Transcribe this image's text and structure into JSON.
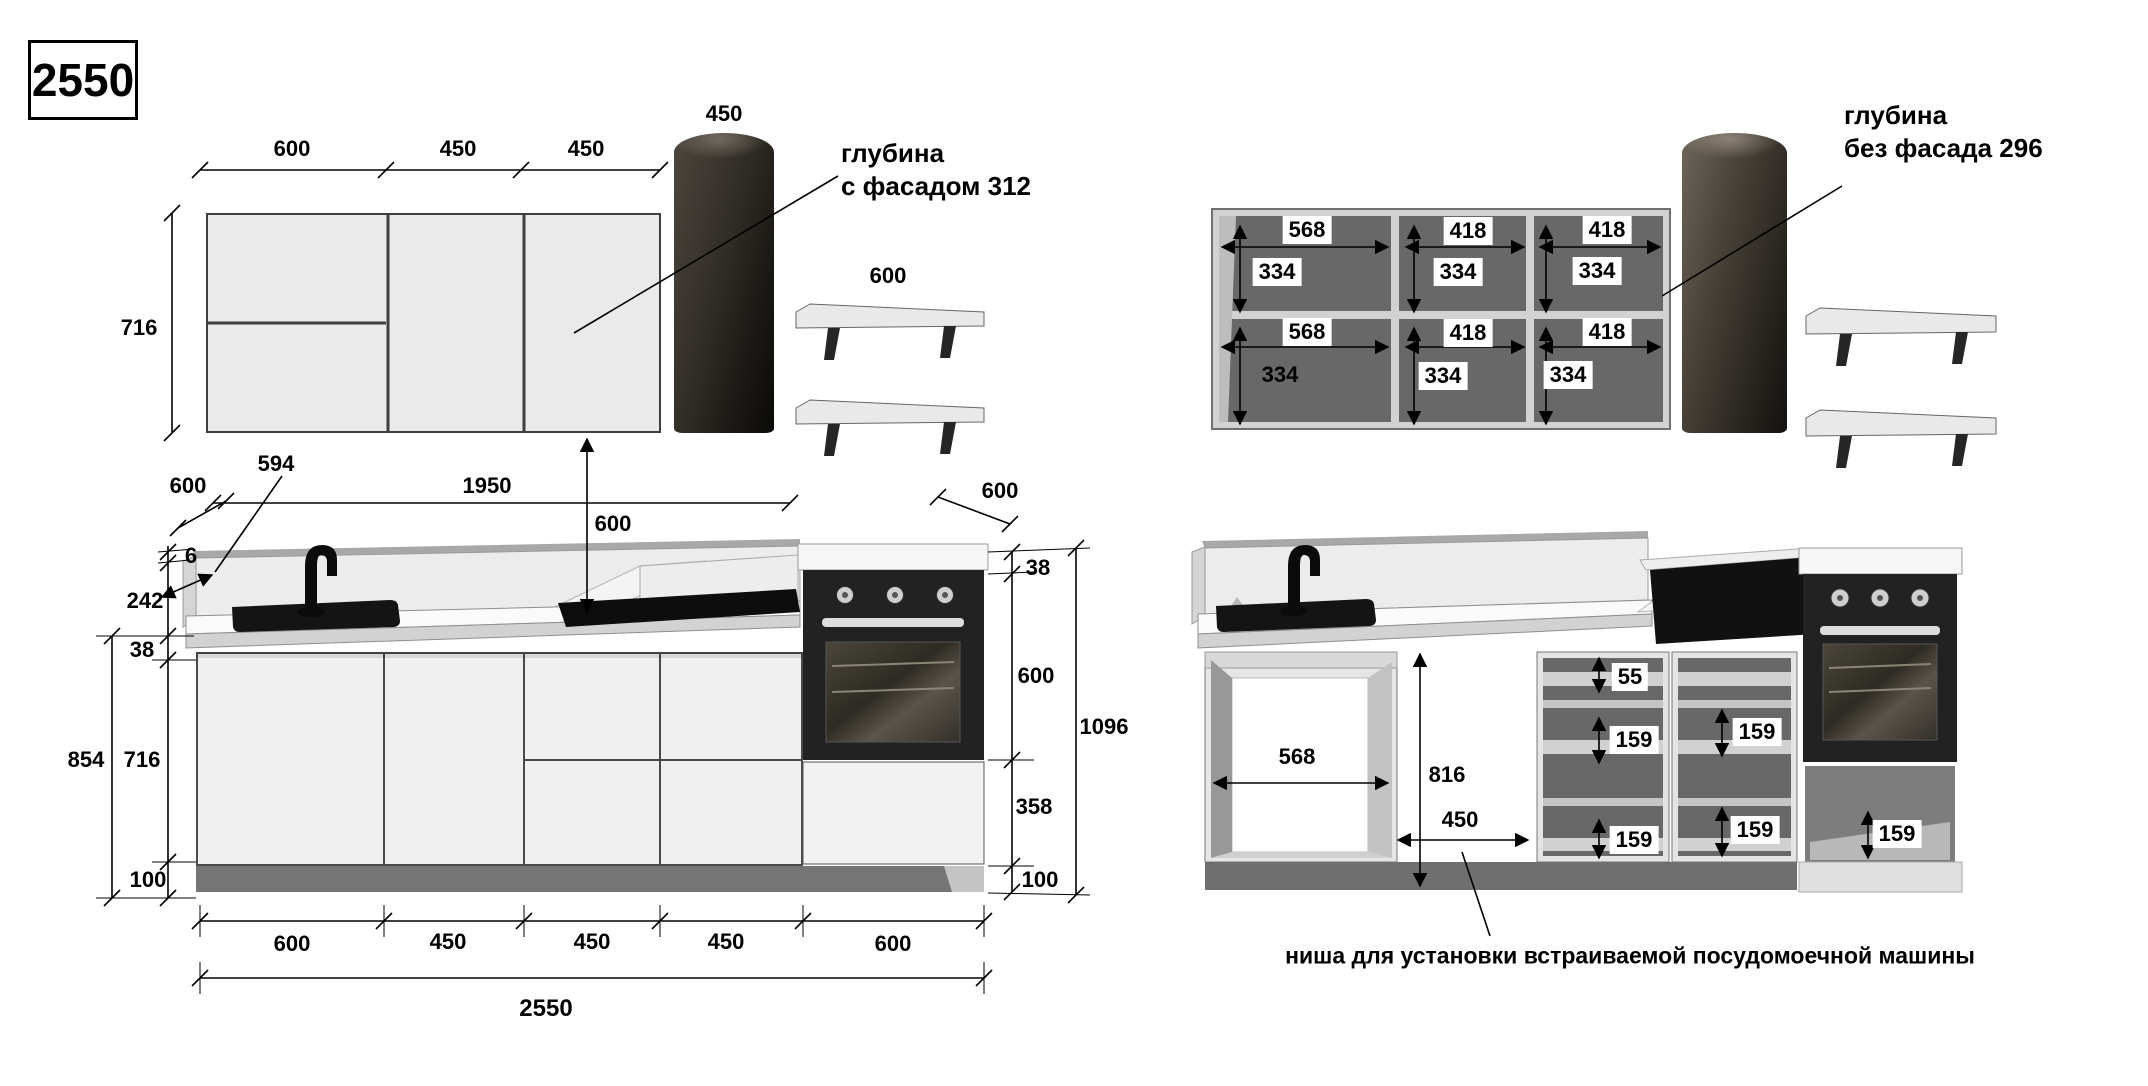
{
  "title_box": {
    "value": "2550"
  },
  "left_view": {
    "top_dims": [
      "600",
      "450",
      "450"
    ],
    "column_width_label": "450",
    "height_label": "716",
    "depth_note": {
      "line1": "глубина",
      "line2": "с фасадом 312"
    },
    "shelf_width_label": "600",
    "mid_dims": {
      "backsplash_594": "594",
      "depth_600": "600",
      "span_1950": "1950",
      "gap_600": "600",
      "shelf_depth_600": "600"
    },
    "left_dims": {
      "top_6": "6",
      "backsplash_242": "242",
      "counter_38": "38",
      "total_854": "854",
      "cabinet_716": "716",
      "plinth_100": "100"
    },
    "right_dims": {
      "counter_38": "38",
      "oven_600": "600",
      "total_1096": "1096",
      "drawer_358": "358",
      "plinth_100": "100"
    },
    "bottom_dims": [
      "600",
      "450",
      "450",
      "450",
      "600"
    ],
    "total_width": "2550"
  },
  "right_view": {
    "upper_compartments": [
      {
        "width": "568",
        "height": "334"
      },
      {
        "width": "418",
        "height": "334"
      },
      {
        "width": "418",
        "height": "334"
      },
      {
        "width": "568",
        "height": "334"
      },
      {
        "width": "418",
        "height": "334"
      },
      {
        "width": "418",
        "height": "334"
      }
    ],
    "depth_note": {
      "line1": "глубина",
      "line2": "без фасада 296"
    },
    "sink_opening_width": "568",
    "niche": {
      "height": "816",
      "width": "450"
    },
    "drawer_unit_a": {
      "top": "55",
      "mid": "159",
      "bottom": "159"
    },
    "drawer_unit_b": {
      "mid": "159",
      "bottom": "159"
    },
    "oven_drawer": "159",
    "dishwasher_note": "ниша для установки встраиваемой посудомоечной машины"
  },
  "colors": {
    "cabinet_front": "#ededed",
    "carcass_interior": "#686868",
    "oven_black": "#232323",
    "plinth_gray": "#757575"
  }
}
